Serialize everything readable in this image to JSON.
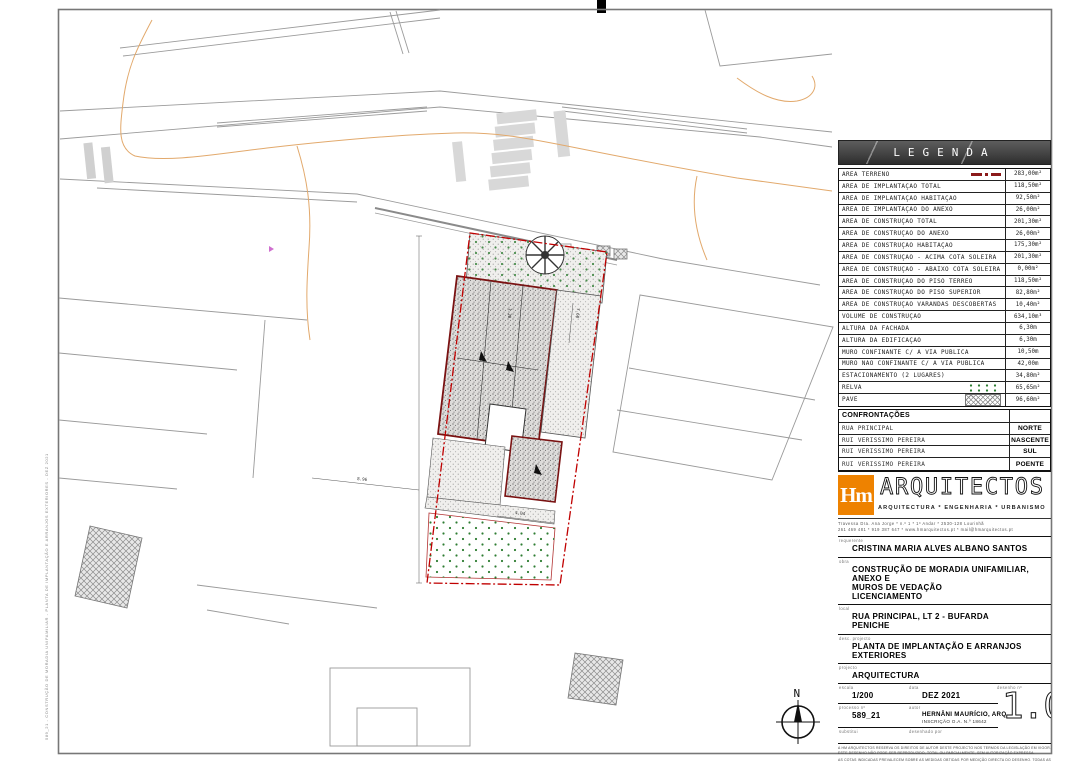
{
  "colors": {
    "accent_orange": "#ee8200",
    "boundary_red": "#c00000",
    "building_red": "#7a1212",
    "grass_green": "#2e7d32",
    "contour_orange": "#e2a96c"
  },
  "plan": {
    "north_label": "N",
    "dimensions": [
      "8.96",
      "4.04",
      "7.60",
      "1.30"
    ]
  },
  "legend": {
    "title": "LEGENDA",
    "rows": [
      {
        "label": "ÁREA TERRENO",
        "value": "283,00m²",
        "symbol": "red-dash-dot-line"
      },
      {
        "label": "ÁREA DE IMPLANTAÇÃO TOTAL",
        "value": "118,50m²"
      },
      {
        "label": "ÁREA DE IMPLANTAÇÃO HABITAÇÃO",
        "value": "92,50m²"
      },
      {
        "label": "ÁREA DE IMPLANTAÇÃO DO ANEXO",
        "value": "26,00m²"
      },
      {
        "label": "ÁREA DE CONSTRUÇÃO TOTAL",
        "value": "201,30m²"
      },
      {
        "label": "ÁREA DE CONSTRUÇÃO DO ANEXO",
        "value": "26,00m²"
      },
      {
        "label": "ÁREA DE CONSTRUÇÃO HABITAÇÃO",
        "value": "175,30m²"
      },
      {
        "label": "ÁREA DE CONSTRUÇÃO - ACIMA COTA SOLEIRA",
        "value": "201,30m²"
      },
      {
        "label": "ÁREA DE CONSTRUÇÃO - ABAIXO COTA SOLEIRA",
        "value": "0,00m²"
      },
      {
        "label": "ÁREA DE CONSTRUÇÃO DO PISO TÉRREO",
        "value": "118,50m²"
      },
      {
        "label": "ÁREA DE CONSTRUÇÃO DO PISO SUPERIOR",
        "value": "82,80m²"
      },
      {
        "label": "ÁREA DE CONSTRUÇÃO VARANDAS DESCOBERTAS",
        "value": "10,40m²"
      },
      {
        "label": "VOLUME DE CONSTRUÇÃO",
        "value": "634,10m³"
      },
      {
        "label": "ALTURA DA FACHADA",
        "value": "6,30m"
      },
      {
        "label": "ALTURA DA EDIFICAÇÃO",
        "value": "6,30m"
      },
      {
        "label": "MURO CONFINANTE C/ A VIA PÚBLICA",
        "value": "10,50m"
      },
      {
        "label": "MURO NÃO CONFINANTE C/ A VIA PÚBLICA",
        "value": "42,00m"
      },
      {
        "label": "ESTACIONAMENTO (2 LUGARES)",
        "value": "34,80m²"
      },
      {
        "label": "RELVA",
        "value": "65,65m²",
        "symbol": "grass-dots"
      },
      {
        "label": "PAVÊ",
        "value": "96,60m²",
        "symbol": "pave-hatch"
      }
    ]
  },
  "confrontacoes": {
    "title": "CONFRONTAÇÕES",
    "rows": [
      {
        "name": "RUA PRINCIPAL",
        "direction": "NORTE"
      },
      {
        "name": "RUI VERISSIMO PEREIRA",
        "direction": "NASCENTE"
      },
      {
        "name": "RUI VERISSIMO PEREIRA",
        "direction": "SUL"
      },
      {
        "name": "RUI VERISSIMO PEREIRA",
        "direction": "POENTE"
      }
    ]
  },
  "firm": {
    "logo_text": "Hm",
    "name": "ARQUITECTOS",
    "tagline": "ARQUITECTURA * ENGENHARIA * URBANISMO",
    "address_line1": "Travessa Dra. Ana Jorge * n.º 1 * 1º Andar * 2530-128 Lourinhã",
    "address_line2": "261 469 481 * 919 387 647 * www.hmarquitectos.pt * mail@hmarquitectos.pt"
  },
  "titleblock": {
    "requerente_label": "requerente",
    "requerente": "CRISTINA MARIA ALVES ALBANO SANTOS",
    "obra_label": "obra",
    "obra_line1": "CONSTRUÇÃO DE MORADIA UNIFAMILIAR, ANEXO E",
    "obra_line2": "MUROS DE VEDAÇÃO",
    "obra_line3": "LICENCIAMENTO",
    "local_label": "local",
    "local_line1": "RUA PRINCIPAL, LT 2 - BUFARDA",
    "local_line2": "PENICHE",
    "desc_label": "desc. projecto",
    "desc": "PLANTA DE IMPLANTAÇÃO E ARRANJOS EXTERIORES",
    "projecto_label": "projecto",
    "projecto": "ARQUITECTURA",
    "escala_label": "escala",
    "escala": "1/200",
    "data_label": "data",
    "data": "DEZ 2021",
    "desenho_label": "desenho nº",
    "desenho_num": "1.00",
    "processo_label": "processo nº",
    "processo": "589_21",
    "autor_label": "autor",
    "autor": "HERNÂNI MAURÍCIO, ARQ",
    "autor_sub": "INSCRIÇÃO O.A. N.º 18642",
    "substitui_label": "substitui",
    "desenhado_label": "desenhado por",
    "disclaimer1": "A HM ARQUITECTOS RESERVA OS DIREITOS DE AUTOR DESTE PROJECTO NOS TERMOS DA LEGISLAÇÃO EM VIGOR. ESTE DESENHO NÃO PODE SER REPRODUZIDO, TOTAL OU PARCIALMENTE, SEM AUTORIZAÇÃO EXPRESSA.",
    "disclaimer2": "AS COTAS INDICADAS PREVALECEM SOBRE AS MEDIDAS OBTIDAS POR MEDIÇÃO DIRECTA DO DESENHO. TODAS AS DIMENSÕES DEVERÃO SER VERIFICADAS EM OBRA PELO EMPREITEIRO."
  },
  "stamp_text": "589_21 - CONSTRUÇÃO DE MORADIA UNIFAMILIAR - PLANTA DE IMPLANTAÇÃO E ARRANJOS EXTERIORES - DEZ 2021"
}
